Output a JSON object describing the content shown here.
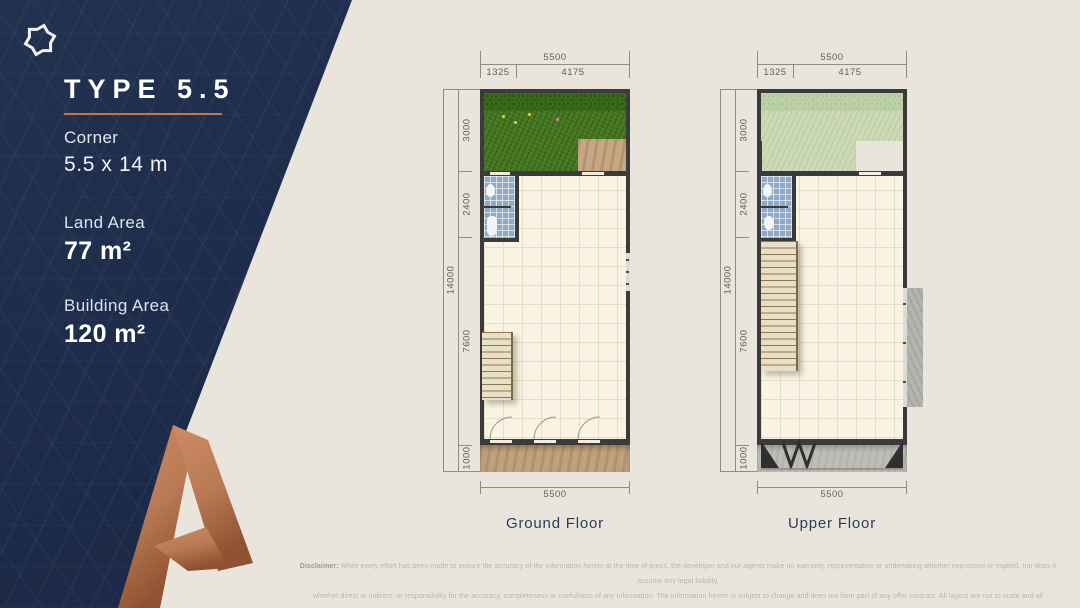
{
  "panel": {
    "brand_icon": "pinwheel-snowflake-icon",
    "watermark_icon": "letter-a-mark-icon",
    "type_title": "TYPE 5.5",
    "subtitle": "Corner",
    "plot_size": "5.5 x 14 m",
    "land_area_label": "Land Area",
    "land_area_value": "77 m²",
    "building_area_label": "Building Area",
    "building_area_value": "120 m²",
    "colors": {
      "navy": "#1d2b4a",
      "accent": "#c1764e",
      "copper": "#b5734d",
      "background": "#e9e5dd"
    }
  },
  "plans": {
    "ground": {
      "label": "Ground Floor",
      "dims": {
        "top_total": "5500",
        "top_left": "1325",
        "top_right": "4175",
        "side_total": "14000",
        "side_seg1": "3000",
        "side_seg2": "2400",
        "side_seg3": "7600",
        "side_seg4": "1000",
        "bottom_total": "5500"
      }
    },
    "upper": {
      "label": "Upper Floor",
      "dims": {
        "top_total": "5500",
        "top_left": "1325",
        "top_right": "4175",
        "side_total": "14000",
        "side_seg1": "3000",
        "side_seg2": "2400",
        "side_seg3": "7600",
        "side_seg4": "1000",
        "bottom_total": "5500"
      }
    }
  },
  "disclaimer": {
    "bold_prefix": "Disclaimer:",
    "line1": "While every effort has been made to ensure the accuracy of the information herein at the time of press, the developer and our agents make no warranty, representation or undertaking whether expressed or implied, nor does it assume any legal liability,",
    "line2": "whether direct or indirect, or responsibility for the accuracy, completeness or usefulness of any information. The information herein is subject to change and does not form part of any offer contract. All layout are not to scale and all illustration are artist impressions only."
  }
}
